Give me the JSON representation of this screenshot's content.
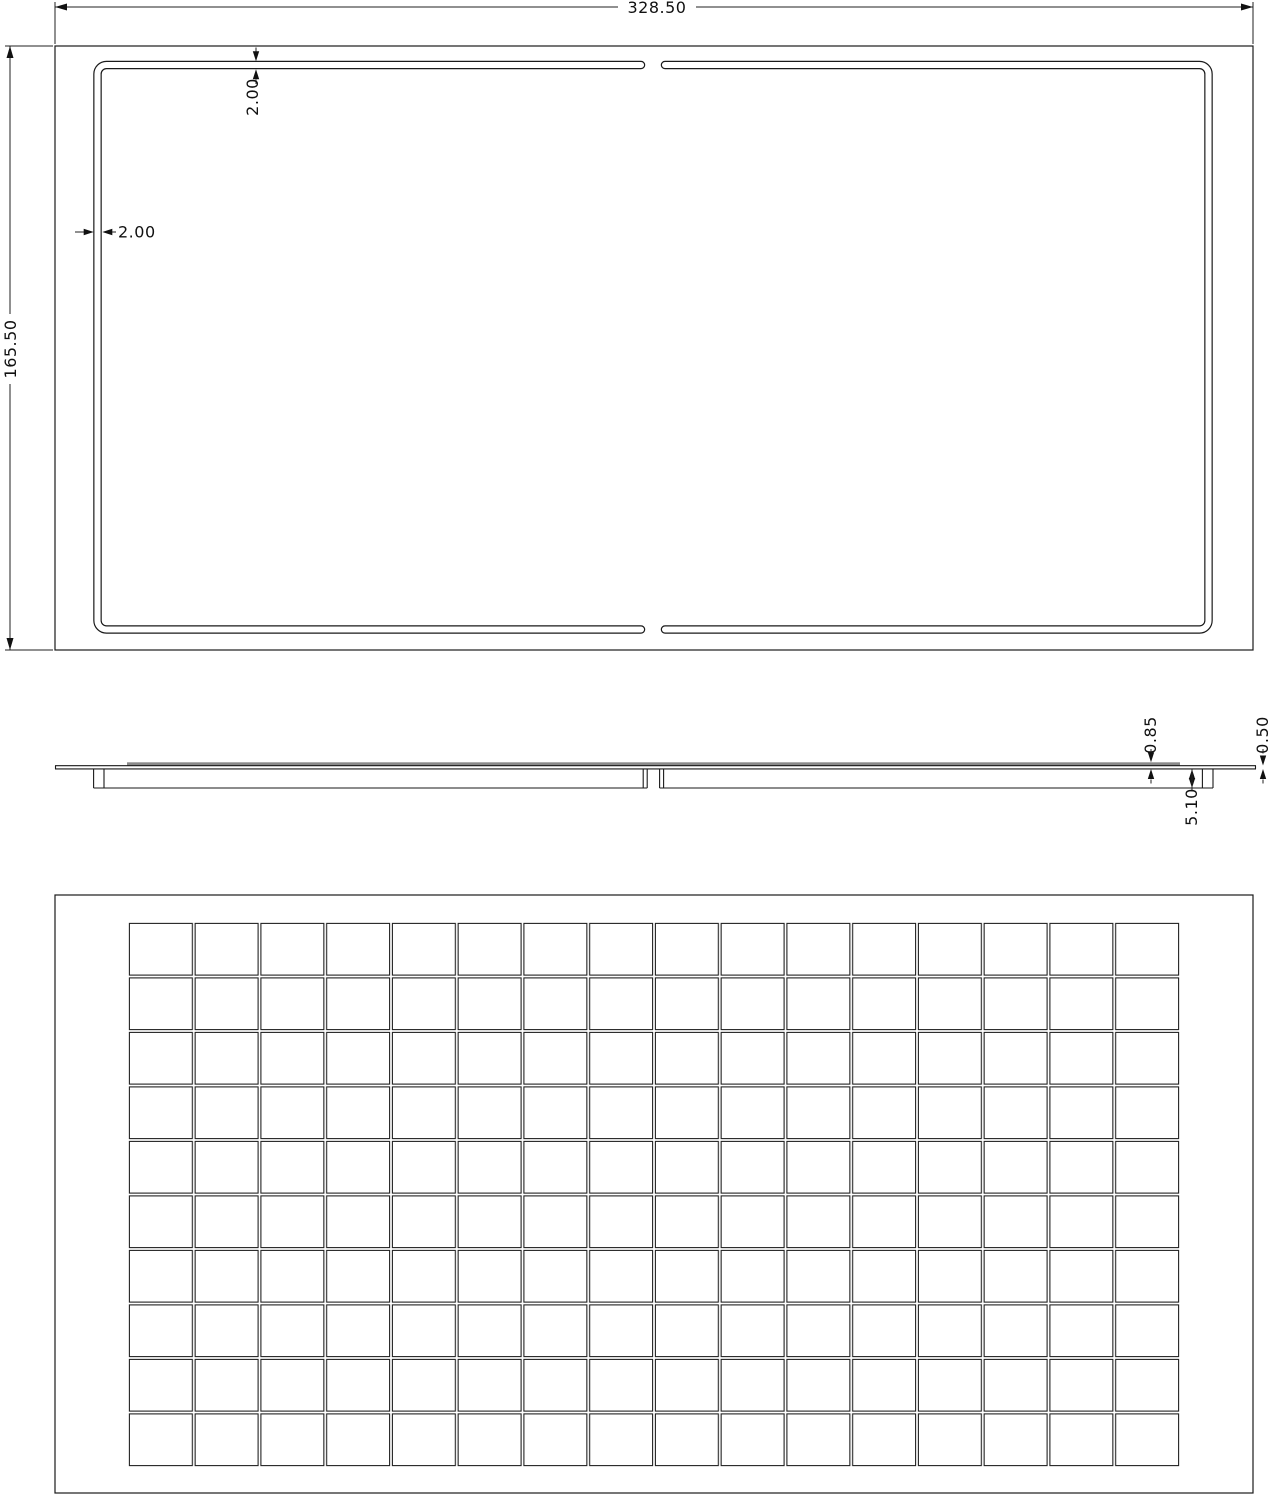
{
  "drawing": {
    "line_color": "#1a1a1a",
    "shading_color": "#8a8a8a",
    "top_view": {
      "overall_width": "328.50",
      "overall_height": "165.50",
      "frame_thickness_top": "2.00",
      "frame_thickness_side": "2.00"
    },
    "side_view": {
      "laminate_thickness": "0.85",
      "sheet_thickness": "0.50",
      "frame_depth": "5.10"
    },
    "bottom_view": {
      "grid_columns": 16,
      "grid_rows": 10,
      "cell_count": 160
    }
  }
}
